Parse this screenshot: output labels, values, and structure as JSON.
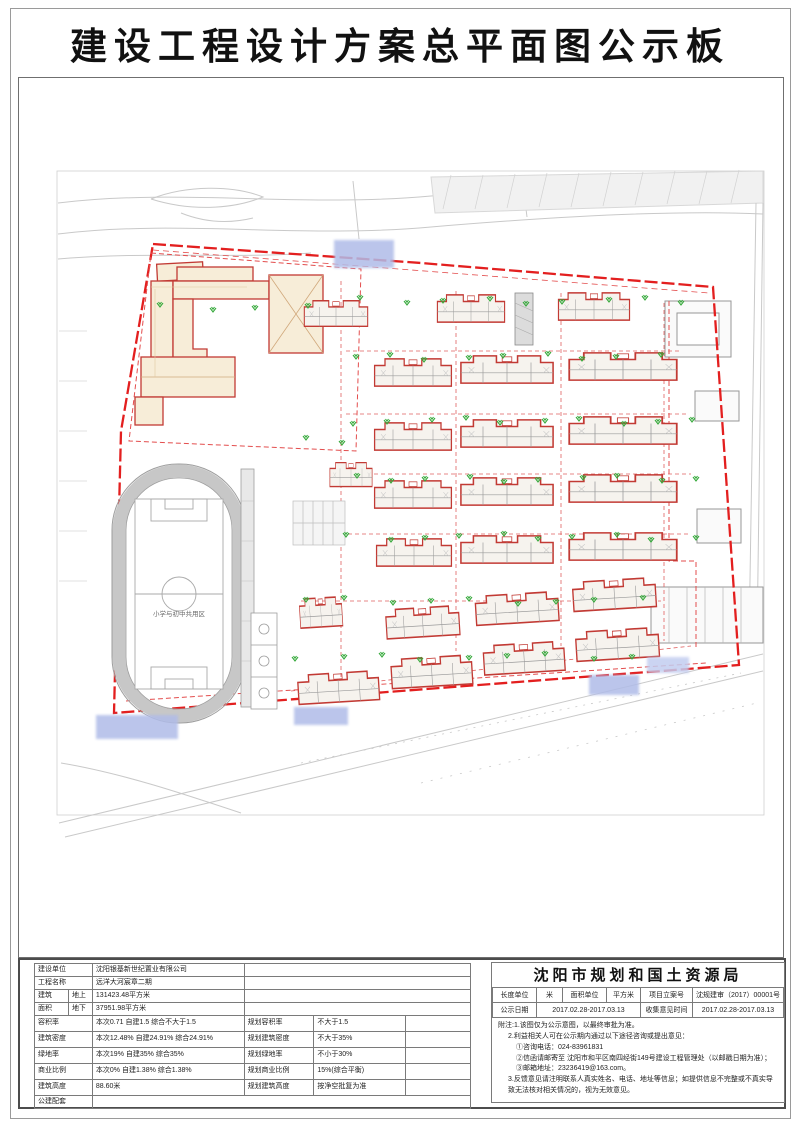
{
  "title": "建设工程设计方案总平面图公示板",
  "drawing": {
    "field_label": "小学与初中共用区"
  },
  "info_table": {
    "basic_rows": [
      {
        "label": "建设单位",
        "value": "沈阳银基新世纪置业有限公司"
      },
      {
        "label": "工程名称",
        "value": "远洋大河宸章二期"
      },
      {
        "label": "建筑",
        "sub": "地上",
        "value": "131423.48平方米"
      },
      {
        "label": "面积",
        "sub": "地下",
        "value": "37951.98平方米"
      }
    ],
    "metric_rows": [
      {
        "label": "容积率",
        "value": "本次0.71 自建1.5 综合不大于1.5",
        "std_label": "规划容积率",
        "std_value": "不大于1.5"
      },
      {
        "label": "建筑密度",
        "value": "本次12.48% 自建24.91% 综合24.91%",
        "std_label": "规划建筑密度",
        "std_value": "不大于35%"
      },
      {
        "label": "绿地率",
        "value": "本次19% 自建35% 综合35%",
        "std_label": "规划绿地率",
        "std_value": "不小于30%"
      },
      {
        "label": "商业比例",
        "value": "本次0% 自建1.38% 综合1.38%",
        "std_label": "规划商业比例",
        "std_value": "15%(综合平衡)"
      },
      {
        "label": "建筑高度",
        "value": "88.60米",
        "std_label": "规划建筑高度",
        "std_value": "按净空批复为准"
      }
    ],
    "last_row_label": "公建配套"
  },
  "authority": {
    "name": "沈阳市规划和国土资源局",
    "meta": {
      "length_unit_label": "长度单位",
      "length_unit": "米",
      "area_unit_label": "面积单位",
      "area_unit": "平方米",
      "case_no_label": "项目立案号",
      "case_no": "沈规建审（2017）00001号",
      "publish_label": "公示日期",
      "publish_date": "2017.02.28-2017.03.13",
      "feedback_label": "收集意见时间",
      "feedback_date": "2017.02.28-2017.03.13"
    },
    "notes": [
      "附注:1.该图仅为公示意图，以最终审批为准。",
      "2.利益相关人可在公示期内通过以下途径咨询或提出意见：",
      "①咨询电话：024-83961831",
      "②信函请邮寄至 沈阳市和平区南四经街149号建设工程管理处（以邮戳日期为准）；",
      "③邮箱地址：23236419@163.com。",
      "3.反馈意见请注明联系人真实姓名、电话、地址等信息；如提供信息不完整或不真实导致无法核对相关情况的，视为无效意见。"
    ]
  }
}
